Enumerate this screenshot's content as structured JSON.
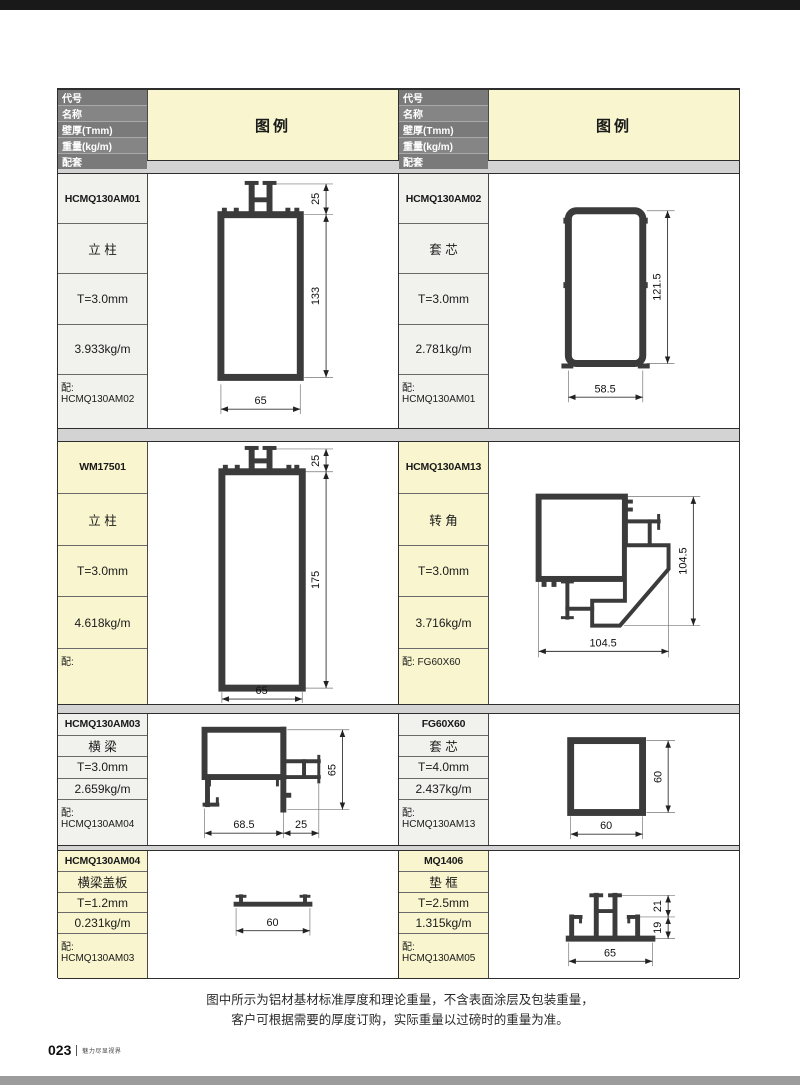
{
  "colors": {
    "c-topbar": "#191919",
    "c-bottombar": "#9c9c9c",
    "c-yellow": "#f9f6cf",
    "c-light": "#f1f1ee",
    "c-grayrow": "#7a7a7a",
    "c-gap": "#d3d3d3",
    "c-line": "#3b3b3b"
  },
  "header": {
    "labels": [
      "代号",
      "名称",
      "壁厚(Tmm)",
      "重量(kg/m)",
      "配套"
    ],
    "legend_label": "图例"
  },
  "profiles": [
    {
      "code": "HCMQ130AM01",
      "name": "立 柱",
      "thickness": "T=3.0mm",
      "weight": "3.933kg/m",
      "match": "配: HCMQ130AM02",
      "dims": {
        "top": "25",
        "height": "133",
        "width": "65"
      }
    },
    {
      "code": "HCMQ130AM02",
      "name": "套 芯",
      "thickness": "T=3.0mm",
      "weight": "2.781kg/m",
      "match": "配: HCMQ130AM01",
      "dims": {
        "height": "121.5",
        "width": "58.5"
      }
    },
    {
      "code": "WM17501",
      "name": "立 柱",
      "thickness": "T=3.0mm",
      "weight": "4.618kg/m",
      "match": "配:",
      "dims": {
        "top": "25",
        "height": "175",
        "width": "65"
      }
    },
    {
      "code": "HCMQ130AM13",
      "name": "转 角",
      "thickness": "T=3.0mm",
      "weight": "3.716kg/m",
      "match": "配: FG60X60",
      "dims": {
        "height": "104.5",
        "width": "104.5"
      }
    },
    {
      "code": "HCMQ130AM03",
      "name": "横 梁",
      "thickness": "T=3.0mm",
      "weight": "2.659kg/m",
      "match": "配: HCMQ130AM04",
      "dims": {
        "height": "65",
        "width_left": "68.5",
        "width_right": "25"
      }
    },
    {
      "code": "FG60X60",
      "name": "套 芯",
      "thickness": "T=4.0mm",
      "weight": "2.437kg/m",
      "match": "配: HCMQ130AM13",
      "dims": {
        "height": "60",
        "width": "60"
      }
    },
    {
      "code": "HCMQ130AM04",
      "name": "横梁盖板",
      "thickness": "T=1.2mm",
      "weight": "0.231kg/m",
      "match": "配: HCMQ130AM03",
      "dims": {
        "width": "60"
      }
    },
    {
      "code": "MQ1406",
      "name": "垫 框",
      "thickness": "T=2.5mm",
      "weight": "1.315kg/m",
      "match": "配: HCMQ130AM05",
      "dims": {
        "top": "21",
        "bottom": "19",
        "width": "65"
      }
    }
  ],
  "footer": {
    "note_line1": "图中所示为铝材基材标准厚度和理论重量，不含表面涂层及包装重量，",
    "note_line2": "客户可根据需要的厚度订购，实际重量以过磅时的重量为准。",
    "page_number": "023",
    "tagline": "魅力尽显视界"
  }
}
